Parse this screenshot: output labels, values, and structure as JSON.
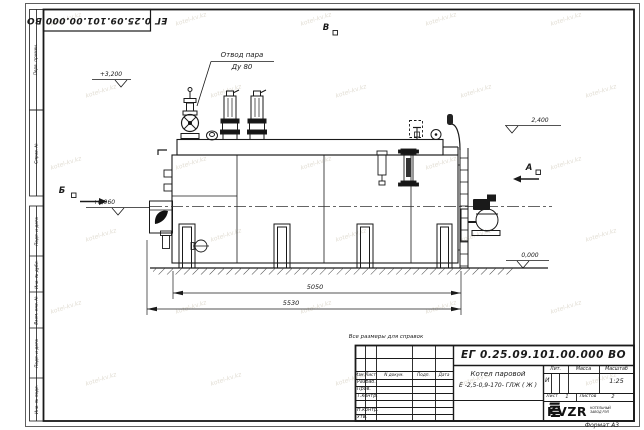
{
  "sheet": {
    "corner_doc_number": "ЕГ 0.25.09.101.00.000  ВО",
    "format_note": "Формат А3",
    "reference_note": "Все размеры для справок",
    "margin_labels": [
      "Перв. примен.",
      "Справ. №",
      "Подп. и дата",
      "Инв. № дубл.",
      "Взам. инв. №",
      "Подп. и дата",
      "Инв. № подл."
    ]
  },
  "drawing": {
    "labels": {
      "steam_outlet_line1": "Отвод пара",
      "steam_outlet_line2": "Ду 80",
      "view_top": "В",
      "view_left": "Б",
      "view_right": "А"
    },
    "elevations": {
      "valve_top": "+3,200",
      "drum_top": "2,400",
      "burner_axis": "+0,960",
      "ground": "0,000"
    },
    "dimensions": {
      "boiler_length": "5050",
      "overall_length": "5530"
    }
  },
  "title_block": {
    "doc_number": "ЕГ 0.25.09.101.00.000  ВО",
    "product_name_line1": "Котел паровой",
    "product_name_line2": "Е -2,5-0,9-170- ГЛЖ ( Ж )",
    "columns": {
      "izm": "Изм.",
      "list": "Лист",
      "n_dokum": "N докум.",
      "podp": "Подп.",
      "data": "Дата"
    },
    "rows": {
      "razrab": "Разраб.",
      "prov": "Пров.",
      "t_kontr": "Т.контр.",
      "n_kontr": "Н.контр.",
      "utv": "Утв."
    },
    "lit_header": "Лит.",
    "mass_header": "Масса",
    "scale_header": "Масштаб",
    "lit_value": "И",
    "scale_value": "1:25",
    "sheet_label": "Лист",
    "sheet_value": "1",
    "sheets_label": "Листов",
    "sheets_value": "2",
    "logo_text": "KVZR",
    "logo_caption_line1": "КОТЕЛЬНЫЙ",
    "logo_caption_line2": "ЗАВОД РЭП"
  },
  "watermark": {
    "text": "kotel-kv.kz"
  },
  "colors": {
    "ink": "#1a1a1a",
    "paper": "#ffffff",
    "watermark": "#c8c0ae"
  }
}
